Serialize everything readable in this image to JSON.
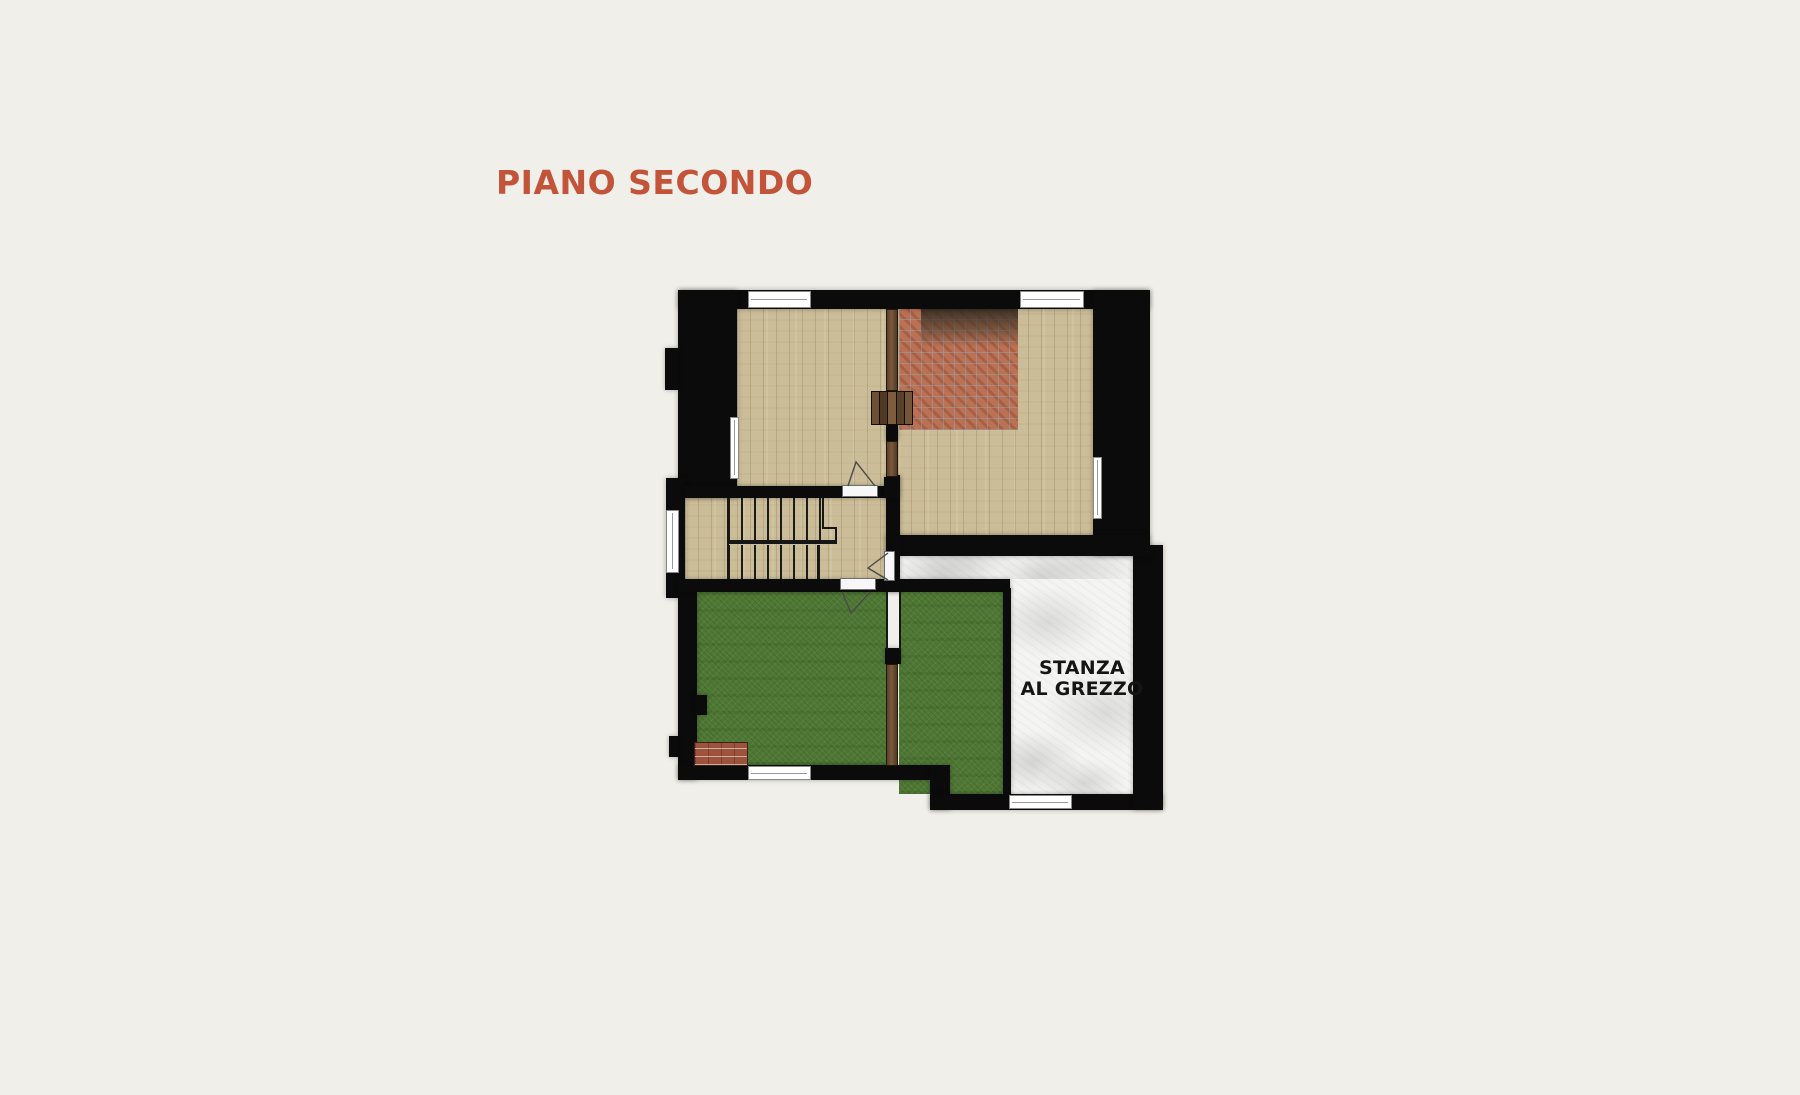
{
  "title": {
    "text": "PIANO SECONDO"
  },
  "labels": {
    "stanza": {
      "line1": "STANZA",
      "line2": "AL GREZZO"
    }
  },
  "palette": {
    "background": "#f0efe9",
    "accent": "#c2543a",
    "wall": "#0b0b0b",
    "wood_floor": "#cbbd98",
    "brick_floor": "#bb7154",
    "grass_floor": "#4f7834",
    "concrete_floor": "#f4f4f2",
    "timber": "#6a4c31",
    "label_text": "#151515"
  }
}
